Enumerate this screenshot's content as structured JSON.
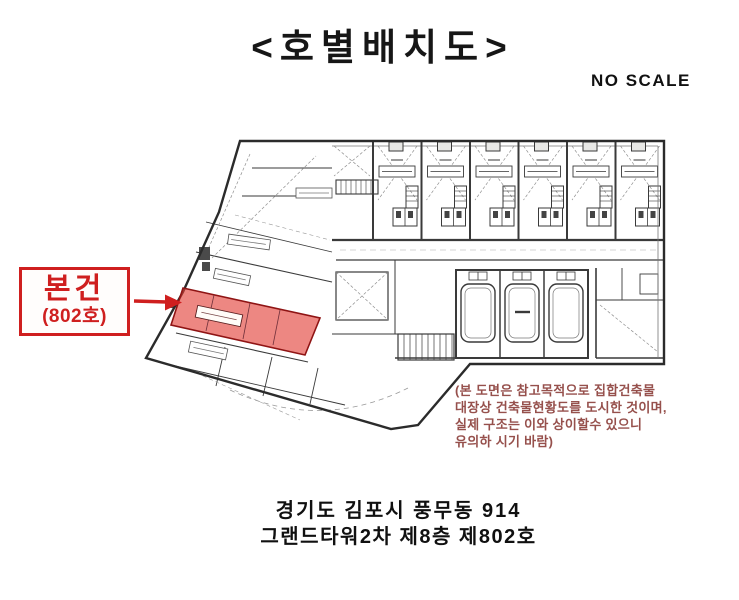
{
  "header": {
    "title": "<호별배치도>",
    "scale_label": "NO SCALE"
  },
  "callout": {
    "label": "본건",
    "unit_number": "(802호)"
  },
  "plan": {
    "subject_unit": "802호",
    "highlight_meaning": "subject-unit-location"
  },
  "plan_note": {
    "line1": "(본 도면은 참고목적으로 집합건축물",
    "line2": "대장상 건축물현황도를 도시한 것이며,",
    "line3": "실제 구조는 이와 상이할수 있으니",
    "line4": "유의하 시기 바람)"
  },
  "address": {
    "line1": "경기도 김포시 풍무동 914",
    "line2": "그랜드타워2차 제8층 제802호"
  },
  "colors": {
    "callout_red": "#cf1f1f",
    "subject_fill": "#e23e36",
    "subject_stroke": "#8f1414",
    "note_red": "#96504c",
    "plan_line": "#3a3a3a"
  }
}
